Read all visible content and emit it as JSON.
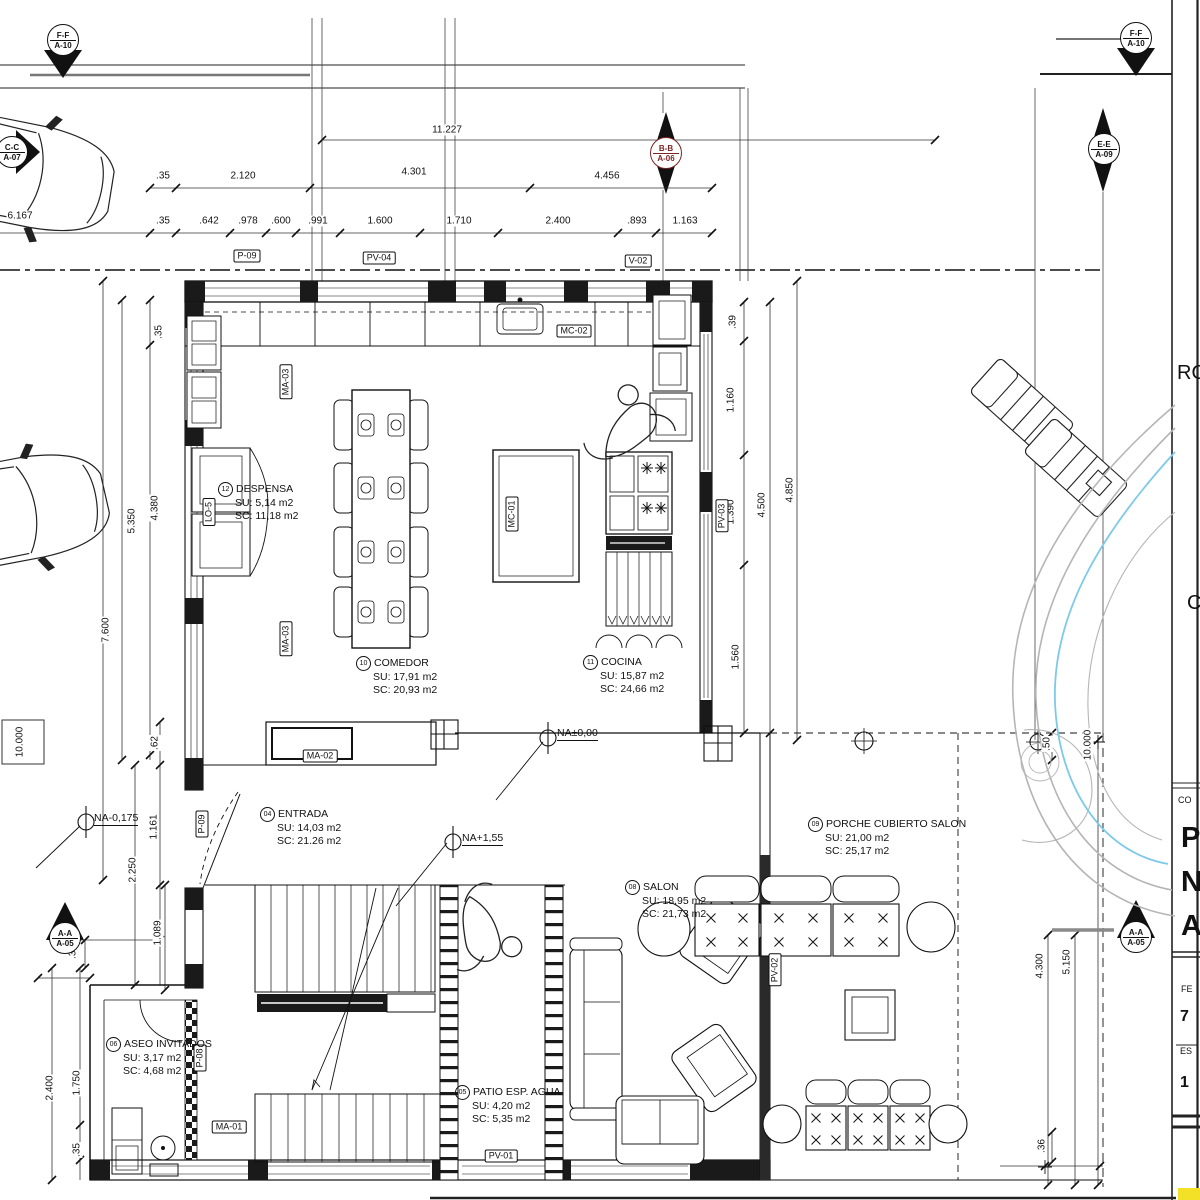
{
  "colors": {
    "line": "#1a1a1a",
    "section_marker_red": "#7a2424",
    "pool_gray": "#b5b5b5",
    "pool_blue": "#7cc9ea",
    "corner_yellow": "#f2e126"
  },
  "markers": [
    {
      "label": "F-F",
      "sheet": "A-10",
      "x": 63,
      "y": 40,
      "color": "#111111"
    },
    {
      "label": "C-C",
      "sheet": "A-07",
      "x": 12,
      "y": 152,
      "color": "#111111"
    },
    {
      "label": "B-B",
      "sheet": "A-06",
      "x": 666,
      "y": 153,
      "color": "#7a2424"
    },
    {
      "label": "E-E",
      "sheet": "A-09",
      "x": 1104,
      "y": 149,
      "color": "#111111"
    },
    {
      "label": "F-F",
      "sheet": "A-10",
      "x": 1136,
      "y": 38,
      "color": "#111111"
    },
    {
      "label": "A-A",
      "sheet": "A-05",
      "x": 65,
      "y": 938,
      "color": "#111111"
    },
    {
      "label": "A-A",
      "sheet": "A-05",
      "x": 1136,
      "y": 937,
      "color": "#111111"
    }
  ],
  "rooms": [
    {
      "num": "12",
      "name": "DESPENSA",
      "su": "SU: 5,14  m2",
      "sc": "SC: 11,18  m2",
      "x": 218,
      "y": 482
    },
    {
      "num": "10",
      "name": "COMEDOR",
      "su": "SU: 17,91  m2",
      "sc": "SC: 20,93  m2",
      "x": 356,
      "y": 656
    },
    {
      "num": "11",
      "name": "COCINA",
      "su": "SU: 15,87  m2",
      "sc": "SC: 24,66  m2",
      "x": 583,
      "y": 655
    },
    {
      "num": "04",
      "name": "ENTRADA",
      "su": "SU: 14,03  m2",
      "sc": "SC: 21.26  m2",
      "x": 260,
      "y": 807
    },
    {
      "num": "08",
      "name": "SALON",
      "su": "SU: 18,95  m2",
      "sc": "SC: 21,73  m2",
      "x": 625,
      "y": 880
    },
    {
      "num": "09",
      "name": "PORCHE CUBIERTO SALON",
      "su": "SU: 21,00  m2",
      "sc": "SC: 25,17  m2",
      "x": 808,
      "y": 817
    },
    {
      "num": "06",
      "name": "ASEO INVITADOS",
      "su": "SU: 3,17  m2",
      "sc": "SC: 4,68  m2",
      "x": 106,
      "y": 1037
    },
    {
      "num": "05",
      "name": "PATIO ESP. AGUA",
      "su": "SU: 4,20  m2",
      "sc": "SC: 5,35  m2",
      "x": 455,
      "y": 1085
    }
  ],
  "levels": [
    {
      "label": "NA±0,00",
      "x": 557,
      "y": 727
    },
    {
      "label": "NA+1,55",
      "x": 462,
      "y": 832
    },
    {
      "label": "NA-0,175",
      "x": 94,
      "y": 812
    }
  ],
  "tags": [
    {
      "label": "P-09",
      "x": 247,
      "y": 256
    },
    {
      "label": "PV-04",
      "x": 379,
      "y": 258
    },
    {
      "label": "V-02",
      "x": 638,
      "y": 261
    },
    {
      "label": "MC-02",
      "x": 574,
      "y": 331
    },
    {
      "label": "MC-01",
      "x": 512,
      "y": 514,
      "v": true
    },
    {
      "label": "PV-03",
      "x": 722,
      "y": 516,
      "v": true
    },
    {
      "label": "MA-03",
      "x": 286,
      "y": 382,
      "v": true
    },
    {
      "label": "MA-03",
      "x": 286,
      "y": 639,
      "v": true
    },
    {
      "label": "MA-02",
      "x": 320,
      "y": 756
    },
    {
      "label": "LO-5",
      "x": 209,
      "y": 512,
      "v": true
    },
    {
      "label": "P-09",
      "x": 202,
      "y": 824,
      "v": true
    },
    {
      "label": "P-08",
      "x": 200,
      "y": 1058,
      "v": true
    },
    {
      "label": "PV-02",
      "x": 775,
      "y": 970,
      "v": true
    },
    {
      "label": "MA-01",
      "x": 229,
      "y": 1127
    },
    {
      "label": "PV-01",
      "x": 501,
      "y": 1156
    }
  ],
  "dimensions": [
    {
      "t": "11.227",
      "x": 447,
      "y": 130
    },
    {
      "t": ".35",
      "x": 163,
      "y": 176
    },
    {
      "t": "2.120",
      "x": 243,
      "y": 176
    },
    {
      "t": "4.301",
      "x": 414,
      "y": 172
    },
    {
      "t": "4.456",
      "x": 607,
      "y": 176
    },
    {
      "t": "6.167",
      "x": 20,
      "y": 216
    },
    {
      "t": ".35",
      "x": 163,
      "y": 221
    },
    {
      "t": ".642",
      "x": 209,
      "y": 221
    },
    {
      "t": ".978",
      "x": 248,
      "y": 221
    },
    {
      "t": ".600",
      "x": 281,
      "y": 221
    },
    {
      "t": ".991",
      "x": 318,
      "y": 221
    },
    {
      "t": "1.600",
      "x": 380,
      "y": 221
    },
    {
      "t": "1.710",
      "x": 459,
      "y": 221
    },
    {
      "t": "2.400",
      "x": 558,
      "y": 221
    },
    {
      "t": ".893",
      "x": 637,
      "y": 221
    },
    {
      "t": "1.163",
      "x": 685,
      "y": 221
    },
    {
      "t": ".35",
      "x": 159,
      "y": 332,
      "v": true
    },
    {
      "t": "4.380",
      "x": 155,
      "y": 508,
      "v": true
    },
    {
      "t": "5.350",
      "x": 132,
      "y": 521,
      "v": true
    },
    {
      "t": "7.600",
      "x": 106,
      "y": 630,
      "v": true
    },
    {
      "t": "10.000",
      "x": 20,
      "y": 742,
      "v": true
    },
    {
      "t": ".62",
      "x": 155,
      "y": 743,
      "v": true
    },
    {
      "t": "1.161",
      "x": 154,
      "y": 827,
      "v": true
    },
    {
      "t": "2.250",
      "x": 133,
      "y": 870,
      "v": true
    },
    {
      "t": "1.089",
      "x": 158,
      "y": 933,
      "v": true
    },
    {
      "t": ".30",
      "x": 73,
      "y": 952,
      "v": true
    },
    {
      "t": "2.400",
      "x": 50,
      "y": 1088,
      "v": true
    },
    {
      "t": "1.750",
      "x": 77,
      "y": 1083,
      "v": true
    },
    {
      "t": ".35",
      "x": 77,
      "y": 1150,
      "v": true
    },
    {
      "t": ".39",
      "x": 733,
      "y": 322,
      "v": true
    },
    {
      "t": "1.160",
      "x": 731,
      "y": 400,
      "v": true
    },
    {
      "t": "1.390",
      "x": 731,
      "y": 512,
      "v": true
    },
    {
      "t": "4.500",
      "x": 762,
      "y": 505,
      "v": true
    },
    {
      "t": "1.560",
      "x": 736,
      "y": 657,
      "v": true
    },
    {
      "t": "4.850",
      "x": 790,
      "y": 490,
      "v": true
    },
    {
      "t": ".50",
      "x": 1047,
      "y": 744,
      "v": true
    },
    {
      "t": "10.000",
      "x": 1088,
      "y": 745,
      "v": true
    },
    {
      "t": "4.300",
      "x": 1040,
      "y": 966,
      "v": true
    },
    {
      "t": "5.150",
      "x": 1067,
      "y": 962,
      "v": true
    },
    {
      "t": ".36",
      "x": 1042,
      "y": 1146,
      "v": true
    }
  ],
  "title_block": {
    "items": [
      {
        "t": "RO",
        "x": 1177,
        "y": 362,
        "cls": "tb-lg"
      },
      {
        "t": "C",
        "x": 1187,
        "y": 592,
        "cls": "tb-lg"
      },
      {
        "t": "CO",
        "x": 1178,
        "y": 795,
        "cls": "tb-sm"
      },
      {
        "t": "P",
        "x": 1181,
        "y": 822,
        "cls": "tb-xl"
      },
      {
        "t": "N",
        "x": 1181,
        "y": 866,
        "cls": "tb-xl"
      },
      {
        "t": "A",
        "x": 1181,
        "y": 910,
        "cls": "tb-xl"
      },
      {
        "t": "FE",
        "x": 1181,
        "y": 984,
        "cls": "tb-sm"
      },
      {
        "t": "7",
        "x": 1180,
        "y": 1008,
        "cls": "tb-md"
      },
      {
        "t": "ES",
        "x": 1180,
        "y": 1046,
        "cls": "tb-sm"
      },
      {
        "t": "1",
        "x": 1180,
        "y": 1074,
        "cls": "tb-md"
      }
    ]
  }
}
